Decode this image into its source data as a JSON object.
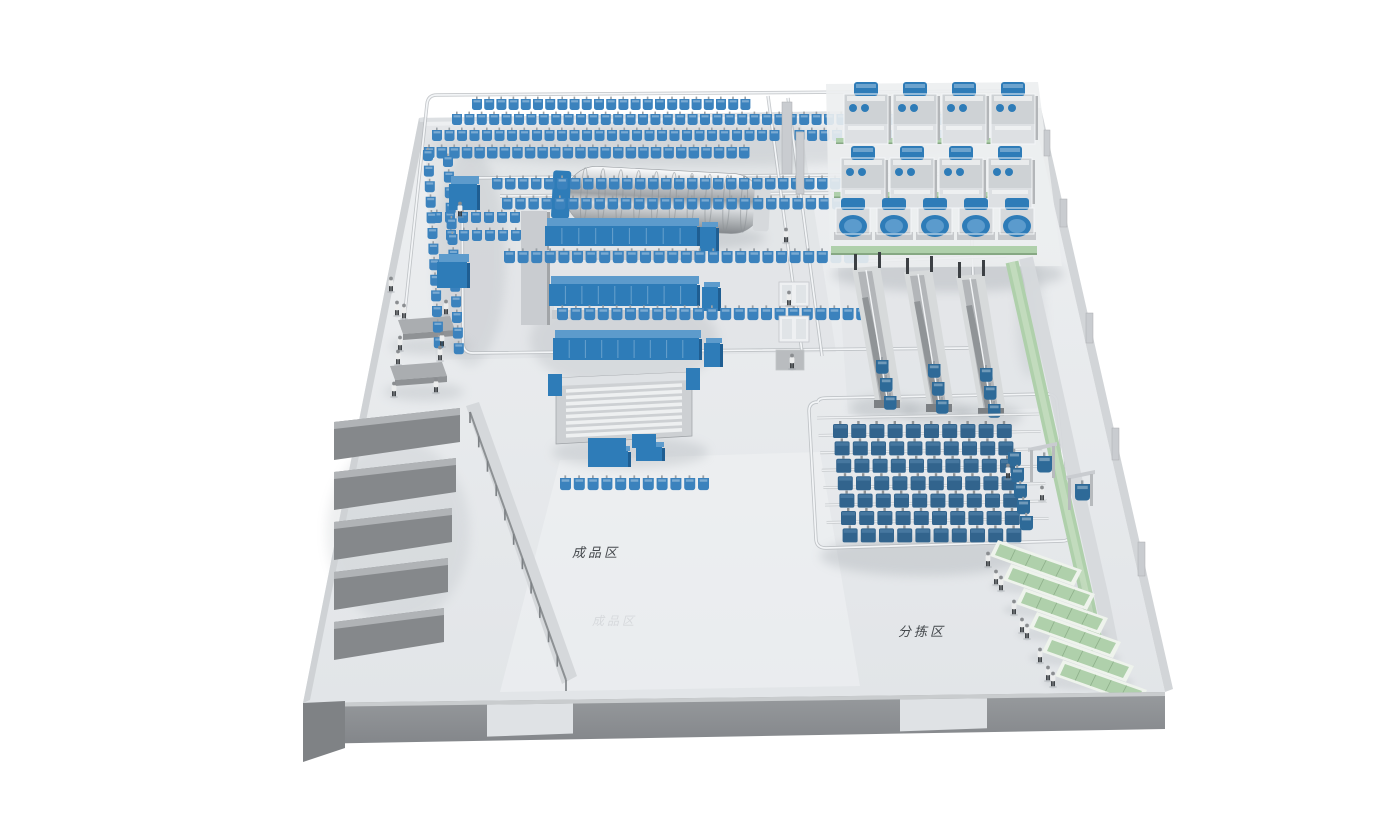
{
  "scene": {
    "labels": {
      "finished_goods_zone": "成品区",
      "sorting_zone": "分拣区",
      "floor_watermark": "成品区"
    },
    "colors": {
      "floor": "#e7eaec",
      "wall_front": "#8f9295",
      "machine_blue": "#2e7cb8",
      "machine_blue_top": "#5d9bcc",
      "machine_blue_side": "#1f5e92",
      "steel_front": "#c9ccd0",
      "steel_top": "#e2e5e8",
      "steel_side": "#a2a5a8",
      "bag_blue": "#3b82bd",
      "bag_dark": "#2e6a98",
      "storage_bag": "#32648d",
      "green_belt": "#afd0ab",
      "green_belt_dark": "#86a883",
      "rail_light": "#f3f5f7",
      "rail_dark": "#b2b6ba",
      "shadow": "#9aa0a6"
    },
    "geometry": {
      "floor": "419,118 1032,108 1165,692 303,703",
      "tints": [
        {
          "points": "424,126 800,118 836,352 436,360",
          "fill": "#e0e3e6",
          "opacity": 0.75
        },
        {
          "points": "838,268 1028,262 1052,408 848,414",
          "fill": "#e1e4e7",
          "opacity": 0.7
        },
        {
          "points": "560,460 820,452 860,686 500,692",
          "fill": "#f0f2f4",
          "opacity": 0.55
        }
      ],
      "under_polys": [
        {
          "name": "left-wall",
          "points": "419,118 427,117 310,700 303,703",
          "fill": "#cfd2d5"
        },
        {
          "name": "top-wall",
          "points": "419,118 1032,108 1033,112 420,122",
          "fill": "#dde0e3"
        },
        {
          "name": "right-wall",
          "points": "1032,108 1041,108 1173,689 1165,692",
          "fill": "#d2d5d8"
        }
      ],
      "bays": [
        {
          "face": "334,422 460,408 460,442 334,460",
          "edge": "334,422 460,408 460,415 334,429"
        },
        {
          "face": "334,472 456,458 456,492 334,510",
          "edge": "334,472 456,458 456,465 334,479"
        },
        {
          "face": "334,522 452,508 452,542 334,560",
          "edge": "334,522 452,508 452,515 334,529"
        },
        {
          "face": "334,572 448,558 448,592 334,610",
          "edge": "334,572 448,558 448,565 334,579"
        },
        {
          "face": "334,622 444,608 444,642 334,660",
          "edge": "334,622 444,608 444,615 334,629"
        }
      ],
      "interior_wall": {
        "points": "466,406 479,402 577,676 562,684",
        "fill": "#d5d8db"
      },
      "railing": {
        "x1": 470,
        "y1": 412,
        "x2": 566,
        "y2": 680,
        "posts": 11,
        "h": 11
      },
      "doors": [
        {
          "x1": 487,
          "x2": 573
        },
        {
          "x1": 900,
          "x2": 987
        }
      ]
    },
    "rails": [
      "M 437,95 L 998,91 Q 1008,91 1009,99 L 1014,130",
      "M 437,95 Q 428,95 427,104 L 403,330",
      "M 462,178 L 960,174 Q 969,174 970,182 L 975,340 Q 975,348 967,348 L 473,353 Q 464,353 463,344 Z",
      "M 500,196 L 942,192",
      "M 768,96 L 802,352",
      "M 788,98 L 822,356",
      "M 818,402 Q 809,402 809,411 L 816,540 Q 817,548 826,548 L 1062,541 Q 1071,541 1070,532 L 1057,402 Q 1056,394 1047,394 L 827,398 Q 818,398 818,402",
      "M 846,262 L 1006,256",
      "M 1046,396 L 1062,470 Q 1074,526 1082,560"
    ],
    "shadows": [
      [
        700,
        146,
        272,
        20,
        0.22
      ],
      [
        470,
        258,
        36,
        108,
        0.2
      ],
      [
        662,
        238,
        104,
        14,
        0.3
      ],
      [
        624,
        340,
        94,
        50,
        0.22
      ],
      [
        630,
        452,
        78,
        16,
        0.26
      ],
      [
        948,
        274,
        116,
        18,
        0.32
      ],
      [
        884,
        408,
        34,
        12,
        0.3
      ],
      [
        936,
        412,
        34,
        12,
        0.3
      ],
      [
        988,
        416,
        34,
        12,
        0.3
      ],
      [
        924,
        556,
        104,
        20,
        0.3
      ],
      [
        430,
        346,
        40,
        9,
        0.25
      ],
      [
        424,
        392,
        40,
        9,
        0.25
      ],
      [
        398,
        532,
        72,
        92,
        0.16
      ],
      [
        1030,
        318,
        14,
        60,
        0.18
      ]
    ],
    "bag_rows_back": [
      {
        "x": 472,
        "y": 99,
        "n": 23,
        "dx": 12.2
      },
      {
        "x": 452,
        "y": 114,
        "n": 41,
        "dx": 12.4
      },
      {
        "x": 432,
        "y": 130,
        "n": 42,
        "dx": 12.5
      },
      {
        "x": 424,
        "y": 147,
        "n": 26,
        "dx": 12.6,
        "s": 1.05
      },
      {
        "x": 432,
        "y": 212,
        "n": 8,
        "dx": 13
      },
      {
        "x": 446,
        "y": 230,
        "n": 8,
        "dx": 13
      }
    ],
    "bag_rows_front": [
      {
        "x": 492,
        "y": 178,
        "n": 30,
        "dx": 13,
        "s": 1.05
      },
      {
        "x": 502,
        "y": 198,
        "n": 28,
        "dx": 13.2,
        "s": 1.05
      },
      {
        "x": 504,
        "y": 251,
        "n": 27,
        "dx": 13.6,
        "s": 1.1
      },
      {
        "x": 557,
        "y": 308,
        "n": 24,
        "dx": 13.6,
        "s": 1.1
      },
      {
        "x": 560,
        "y": 478,
        "n": 11,
        "dx": 13.8,
        "s": 1.1
      }
    ],
    "bag_cols": [
      {
        "x": 423,
        "y": 150,
        "n": 13,
        "dy": 15.6,
        "ddx": 0.9
      },
      {
        "x": 443,
        "y": 156,
        "n": 13,
        "dy": 15.6,
        "ddx": 0.9
      },
      {
        "x": 1008,
        "y": 452,
        "n": 5,
        "dy": 16,
        "ddx": 3,
        "s": 1.3,
        "fill": "#2e6a98"
      }
    ],
    "washer": {
      "x": 566,
      "y": 170,
      "w": 196,
      "h": 60,
      "ribs": 10
    },
    "machines": [
      {
        "x": 449,
        "y": 176,
        "w": 28,
        "h": 26,
        "d": 8,
        "top": "#5d9bcc",
        "front": "#2e7cb8",
        "side": "#1f5e92"
      },
      {
        "x": 521,
        "y": 206,
        "w": 26,
        "h": 114,
        "d": 5,
        "top": "#e2e5e8",
        "front": "#c9ccd0",
        "side": "#a2a5a8"
      },
      {
        "x": 545,
        "y": 218,
        "w": 152,
        "h": 20,
        "d": 8,
        "top": "#5d9bcc",
        "front": "#2e7cb8",
        "side": "#1f5e92"
      },
      {
        "x": 547,
        "y": 246,
        "w": 150,
        "h": 10,
        "d": 4,
        "top": "#e2e5e8",
        "front": "#c9ccd0",
        "side": "#a2a5a8"
      },
      {
        "x": 437,
        "y": 254,
        "w": 30,
        "h": 26,
        "d": 8,
        "top": "#5d9bcc",
        "front": "#2e7cb8",
        "side": "#1f5e92"
      },
      {
        "x": 549,
        "y": 276,
        "w": 148,
        "h": 22,
        "d": 8,
        "top": "#5d9bcc",
        "front": "#2e7cb8",
        "side": "#1f5e92"
      },
      {
        "x": 552,
        "y": 306,
        "w": 146,
        "h": 9,
        "d": 4,
        "top": "#e2e5e8",
        "front": "#c9ccd0",
        "side": "#a2a5a8"
      },
      {
        "x": 553,
        "y": 330,
        "w": 146,
        "h": 22,
        "d": 8,
        "top": "#5d9bcc",
        "front": "#2e7cb8",
        "side": "#1f5e92"
      },
      {
        "x": 700,
        "y": 222,
        "w": 16,
        "h": 24,
        "d": 5,
        "top": "#5d9bcc",
        "front": "#2e7cb8",
        "side": "#1f5e92"
      },
      {
        "x": 702,
        "y": 282,
        "w": 16,
        "h": 24,
        "d": 5,
        "top": "#5d9bcc",
        "front": "#2e7cb8",
        "side": "#1f5e92"
      },
      {
        "x": 704,
        "y": 338,
        "w": 16,
        "h": 24,
        "d": 5,
        "top": "#5d9bcc",
        "front": "#2e7cb8",
        "side": "#1f5e92"
      },
      {
        "x": 588,
        "y": 446,
        "w": 40,
        "h": 16,
        "d": 5,
        "top": "#5d9bcc",
        "front": "#2e7cb8",
        "side": "#1f5e92"
      },
      {
        "x": 636,
        "y": 442,
        "w": 26,
        "h": 14,
        "d": 5,
        "top": "#5d9bcc",
        "front": "#2e7cb8",
        "side": "#1f5e92"
      }
    ],
    "spreader": {
      "x": 556,
      "y": 372,
      "w": 136,
      "h": 72
    },
    "feeders": {
      "deck": "826,84 1038,82 1062,266 830,268",
      "belts_back": [
        {
          "x": 836,
          "y": 138,
          "w": 192,
          "h": 6
        },
        {
          "x": 834,
          "y": 192,
          "w": 198,
          "h": 6
        },
        {
          "x": 864,
          "y": 146,
          "w": 6,
          "h": 48
        },
        {
          "x": 913,
          "y": 150,
          "w": 6,
          "h": 46
        },
        {
          "x": 962,
          "y": 152,
          "w": 6,
          "h": 44
        }
      ],
      "belt_front": {
        "x": 831,
        "y": 246,
        "w": 206,
        "h": 9
      },
      "rows": [
        {
          "type": "large",
          "x": 844,
          "y": 86,
          "n": 4,
          "dx": 49
        },
        {
          "type": "large",
          "x": 841,
          "y": 150,
          "n": 4,
          "dx": 49
        },
        {
          "type": "small",
          "x": 836,
          "y": 202,
          "n": 5,
          "dx": 41
        }
      ]
    },
    "monorails": [
      {
        "x": 852,
        "y": 268
      },
      {
        "x": 904,
        "y": 272
      },
      {
        "x": 956,
        "y": 276
      }
    ],
    "storage_grid": {
      "x0": 833,
      "y0": 424,
      "cols": 10,
      "rows": 7,
      "dx": 18.2,
      "dy": 17.4,
      "rdx": 1.6
    },
    "right_belt": {
      "walkway_d": "M 1026,258 L 1044,338 L 1064,428 L 1082,510 L 1102,598 L 1112,648",
      "belt_d": "M 1012,262 L 1030,342 L 1050,432 L 1068,514 L 1088,602 L 1098,650"
    },
    "sort_conveyors": [
      {
        "x": 998,
        "y": 540
      },
      {
        "x": 1011,
        "y": 564
      },
      {
        "x": 1024,
        "y": 588
      },
      {
        "x": 1037,
        "y": 612
      },
      {
        "x": 1050,
        "y": 636
      },
      {
        "x": 1063,
        "y": 660
      }
    ],
    "lifts": [
      {
        "x": 1030,
        "y": 478
      },
      {
        "x": 1068,
        "y": 506
      }
    ],
    "crates": [
      {
        "x": 779,
        "y": 282,
        "w": 30,
        "h": 24
      },
      {
        "x": 779,
        "y": 316,
        "w": 30,
        "h": 26
      },
      {
        "x": 776,
        "y": 350,
        "w": 28,
        "h": 20,
        "dark": true
      }
    ],
    "pillars": [
      {
        "x": 782,
        "y": 102,
        "w": 10,
        "h": 72
      },
      {
        "x": 796,
        "y": 132,
        "w": 8,
        "h": 62
      },
      {
        "x": 1044,
        "y": 130,
        "w": 6,
        "h": 26
      },
      {
        "x": 1060,
        "y": 199,
        "w": 7,
        "h": 28
      },
      {
        "x": 1086,
        "y": 313,
        "w": 7,
        "h": 30
      },
      {
        "x": 1112,
        "y": 428,
        "w": 7,
        "h": 32
      },
      {
        "x": 1138,
        "y": 542,
        "w": 7,
        "h": 34
      }
    ],
    "tables": [
      {
        "x": 398,
        "y": 316
      },
      {
        "x": 390,
        "y": 362
      }
    ],
    "people": [
      {
        "x": 404,
        "y": 318
      },
      {
        "x": 446,
        "y": 314
      },
      {
        "x": 400,
        "y": 350
      },
      {
        "x": 442,
        "y": 346
      },
      {
        "x": 398,
        "y": 364
      },
      {
        "x": 440,
        "y": 360
      },
      {
        "x": 394,
        "y": 396
      },
      {
        "x": 436,
        "y": 392
      },
      {
        "x": 391,
        "y": 291
      },
      {
        "x": 397,
        "y": 315
      },
      {
        "x": 786,
        "y": 242
      },
      {
        "x": 789,
        "y": 305
      },
      {
        "x": 792,
        "y": 368
      },
      {
        "x": 460,
        "y": 216
      },
      {
        "x": 1008,
        "y": 478
      },
      {
        "x": 1042,
        "y": 500
      },
      {
        "x": 988,
        "y": 566
      },
      {
        "x": 996,
        "y": 584
      },
      {
        "x": 1001,
        "y": 590
      },
      {
        "x": 1014,
        "y": 614
      },
      {
        "x": 1022,
        "y": 632
      },
      {
        "x": 1027,
        "y": 638
      },
      {
        "x": 1040,
        "y": 662
      },
      {
        "x": 1048,
        "y": 680
      },
      {
        "x": 1053,
        "y": 686
      }
    ]
  }
}
